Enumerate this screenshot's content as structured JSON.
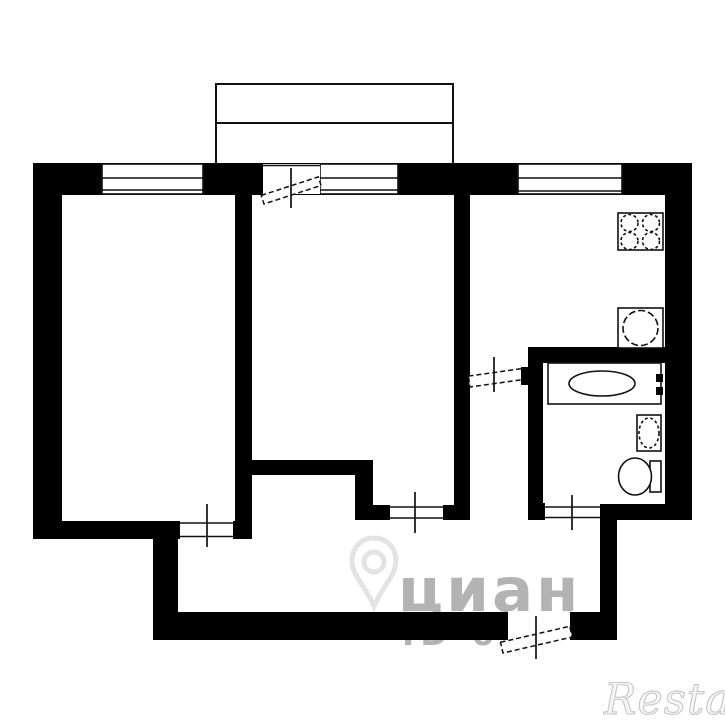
{
  "plan": {
    "kind": "apartment-floor-plan",
    "rooms": [
      {
        "name": "room-left"
      },
      {
        "name": "room-middle"
      },
      {
        "name": "kitchen"
      },
      {
        "name": "bathroom"
      },
      {
        "name": "hallway"
      },
      {
        "name": "balcony"
      }
    ],
    "fixtures": [
      {
        "name": "stove-4-burners"
      },
      {
        "name": "kitchen-sink"
      },
      {
        "name": "bathtub"
      },
      {
        "name": "washbasin"
      },
      {
        "name": "toilet"
      }
    ],
    "doors": [
      {
        "name": "balcony-door"
      },
      {
        "name": "room-left-door"
      },
      {
        "name": "room-middle-door"
      },
      {
        "name": "kitchen-door"
      },
      {
        "name": "bathroom-door"
      },
      {
        "name": "entrance-door"
      }
    ],
    "windows": [
      {
        "name": "room-left-window"
      },
      {
        "name": "balcony-window"
      },
      {
        "name": "kitchen-window"
      }
    ],
    "colors": {
      "walls": "#000000",
      "lines": "#111111",
      "background": "#ffffff"
    }
  },
  "watermarks": {
    "cian": {
      "text": "циан",
      "id_text": "ID 69",
      "color": "#b3b3b3"
    },
    "restate": {
      "text": "Restate",
      "color": "#c6c6c6"
    }
  }
}
